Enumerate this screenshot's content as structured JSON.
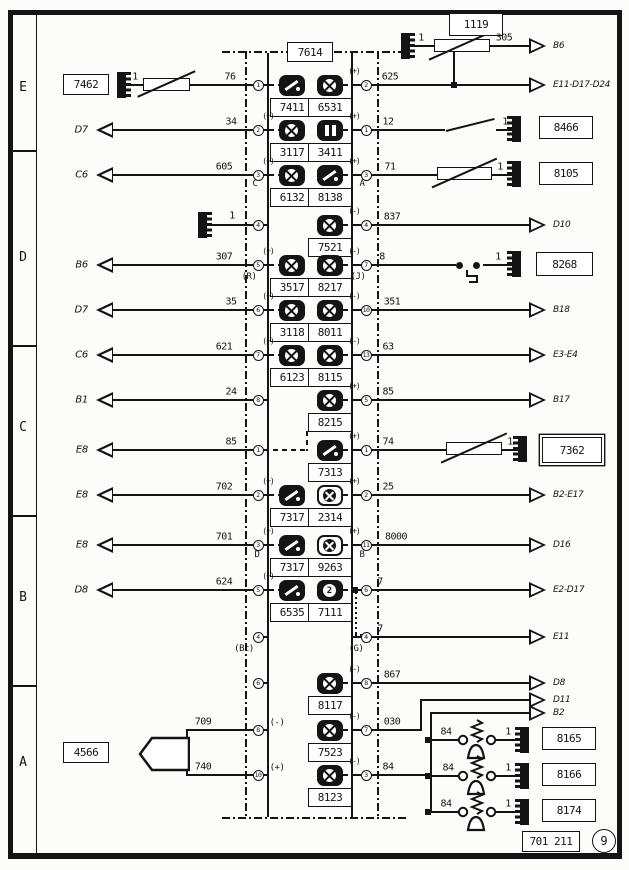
{
  "page": {
    "number": "9",
    "plate": "701 211"
  },
  "unit": {
    "id": "7614"
  },
  "ruler": [
    "E",
    "D",
    "C",
    "B",
    "A"
  ],
  "diagram": {
    "lines": [
      [
        222,
        51,
        186,
        2,
        "ddh"
      ],
      [
        222,
        817,
        186,
        2,
        "ddh"
      ],
      [
        245,
        51,
        2,
        768,
        "ddv"
      ],
      [
        377,
        51,
        2,
        768,
        "ddv"
      ],
      [
        267,
        53,
        2,
        764,
        "s"
      ],
      [
        351,
        53,
        2,
        764,
        "s"
      ],
      [
        128,
        84,
        16,
        2,
        "s"
      ],
      [
        190,
        84,
        63,
        2,
        "s"
      ],
      [
        112,
        129,
        141,
        2,
        "s"
      ],
      [
        112,
        174,
        141,
        2,
        "s"
      ],
      [
        208,
        224,
        45,
        2,
        "s"
      ],
      [
        112,
        264,
        141,
        2,
        "s"
      ],
      [
        112,
        309,
        141,
        2,
        "s"
      ],
      [
        112,
        354,
        141,
        2,
        "s"
      ],
      [
        112,
        399,
        141,
        2,
        "s"
      ],
      [
        112,
        449,
        141,
        2,
        "s"
      ],
      [
        112,
        494,
        141,
        2,
        "s"
      ],
      [
        112,
        544,
        141,
        2,
        "s"
      ],
      [
        112,
        589,
        141,
        2,
        "s"
      ],
      [
        188,
        729,
        65,
        2,
        "s"
      ],
      [
        188,
        774,
        65,
        2,
        "s"
      ],
      [
        186,
        729,
        2,
        47,
        "s"
      ],
      [
        411,
        45,
        24,
        2,
        "s"
      ],
      [
        490,
        45,
        40,
        2,
        "s"
      ],
      [
        453,
        51,
        2,
        35,
        "s"
      ],
      [
        371,
        84,
        159,
        2,
        "s"
      ],
      [
        371,
        129,
        74,
        2,
        "s"
      ],
      [
        496,
        129,
        16,
        2,
        "s"
      ],
      [
        371,
        174,
        66,
        2,
        "s"
      ],
      [
        492,
        174,
        20,
        2,
        "s"
      ],
      [
        371,
        224,
        159,
        2,
        "s"
      ],
      [
        371,
        264,
        85,
        2,
        "s"
      ],
      [
        483,
        264,
        29,
        2,
        "s"
      ],
      [
        371,
        309,
        159,
        2,
        "s"
      ],
      [
        371,
        354,
        159,
        2,
        "s"
      ],
      [
        371,
        399,
        159,
        2,
        "s"
      ],
      [
        371,
        449,
        75,
        2,
        "s"
      ],
      [
        502,
        449,
        16,
        2,
        "s"
      ],
      [
        371,
        494,
        159,
        2,
        "s"
      ],
      [
        371,
        544,
        159,
        2,
        "s"
      ],
      [
        371,
        589,
        159,
        2,
        "s"
      ],
      [
        371,
        636,
        159,
        2,
        "s"
      ],
      [
        371,
        682,
        159,
        2,
        "s"
      ],
      [
        420,
        699,
        110,
        2,
        "s"
      ],
      [
        420,
        699,
        2,
        32,
        "s"
      ],
      [
        430,
        712,
        110,
        2,
        "s"
      ],
      [
        430,
        712,
        2,
        101,
        "s"
      ],
      [
        371,
        729,
        51,
        2,
        "s"
      ],
      [
        371,
        774,
        59,
        2,
        "s"
      ],
      [
        430,
        739,
        29,
        2,
        "s"
      ],
      [
        496,
        739,
        24,
        2,
        "s"
      ],
      [
        430,
        775,
        29,
        2,
        "s"
      ],
      [
        496,
        775,
        24,
        2,
        "s"
      ],
      [
        430,
        811,
        29,
        2,
        "s"
      ],
      [
        496,
        811,
        24,
        2,
        "s"
      ],
      [
        264,
        449,
        44,
        2,
        "dah"
      ],
      [
        306,
        431,
        2,
        20,
        "dav"
      ],
      [
        355,
        592,
        2,
        44,
        "dov"
      ],
      [
        355,
        634,
        8,
        2,
        "doh"
      ],
      [
        466,
        270,
        2,
        7,
        "s"
      ],
      [
        466,
        275,
        12,
        2,
        "s"
      ],
      [
        476,
        275,
        2,
        8,
        "s"
      ],
      [
        469,
        281,
        9,
        2,
        "s"
      ]
    ],
    "squares": [
      [
        454,
        85
      ],
      [
        355,
        590
      ],
      [
        428,
        740
      ],
      [
        428,
        776
      ],
      [
        428,
        812
      ]
    ],
    "dots": [
      [
        459,
        265
      ],
      [
        476,
        265
      ]
    ],
    "grounds": [
      [
        117,
        72,
        "r"
      ],
      [
        198,
        212,
        "r"
      ],
      [
        401,
        33,
        "r"
      ],
      [
        512,
        116,
        "l"
      ],
      [
        512,
        161,
        "l"
      ],
      [
        512,
        251,
        "l"
      ],
      [
        518,
        436,
        "l"
      ],
      [
        520,
        727,
        "l"
      ],
      [
        520,
        763,
        "l"
      ],
      [
        520,
        799,
        "l"
      ]
    ],
    "resistors": [
      [
        143,
        78,
        47
      ],
      [
        434,
        39,
        56
      ],
      [
        437,
        167,
        55
      ],
      [
        446,
        442,
        56
      ]
    ],
    "switches": [
      [
        446,
        130,
        50,
        -14
      ]
    ],
    "pumps": [
      [
        453,
        718
      ],
      [
        453,
        754
      ],
      [
        453,
        790
      ]
    ],
    "horn": [
      138,
      736
    ],
    "arrows": [
      [
        "l",
        96,
        130,
        "D7"
      ],
      [
        "l",
        96,
        175,
        "C6"
      ],
      [
        "l",
        96,
        265,
        "B6"
      ],
      [
        "l",
        96,
        310,
        "D7"
      ],
      [
        "l",
        96,
        355,
        "C6"
      ],
      [
        "l",
        96,
        400,
        "B1"
      ],
      [
        "l",
        96,
        450,
        "E8"
      ],
      [
        "l",
        96,
        495,
        "E8"
      ],
      [
        "l",
        96,
        545,
        "E8"
      ],
      [
        "l",
        96,
        590,
        "D8"
      ],
      [
        "r",
        546,
        46,
        "B6"
      ],
      [
        "r",
        546,
        85,
        "E11-D17-D24"
      ],
      [
        "r",
        546,
        225,
        "D10"
      ],
      [
        "r",
        546,
        310,
        "B18"
      ],
      [
        "r",
        546,
        355,
        "E3-E4"
      ],
      [
        "r",
        546,
        400,
        "B17"
      ],
      [
        "r",
        546,
        495,
        "B2-E17"
      ],
      [
        "r",
        546,
        545,
        "D16"
      ],
      [
        "r",
        546,
        590,
        "E2-D17"
      ],
      [
        "r",
        546,
        637,
        "E11"
      ],
      [
        "r",
        546,
        683,
        "D8"
      ],
      [
        "r",
        546,
        700,
        "D11"
      ],
      [
        "r",
        546,
        713,
        "B2"
      ]
    ],
    "boxes": [
      [
        "7462",
        63,
        74,
        46,
        21,
        0
      ],
      [
        "1119",
        449,
        13,
        54,
        23,
        0
      ],
      [
        "8466",
        539,
        116,
        54,
        23,
        0
      ],
      [
        "8105",
        539,
        162,
        54,
        23,
        0
      ],
      [
        "8268",
        536,
        252,
        57,
        24,
        0
      ],
      [
        "7362",
        542,
        437,
        60,
        26,
        1
      ],
      [
        "4566",
        63,
        742,
        46,
        21,
        0
      ],
      [
        "8165",
        542,
        727,
        54,
        23,
        0
      ],
      [
        "8166",
        542,
        763,
        54,
        23,
        0
      ],
      [
        "8174",
        542,
        799,
        54,
        23,
        0
      ]
    ],
    "pins": [
      [
        "1",
        258,
        85
      ],
      [
        "2",
        258,
        130
      ],
      [
        "3",
        258,
        175
      ],
      [
        "4",
        258,
        225
      ],
      [
        "5",
        258,
        265
      ],
      [
        "6",
        258,
        310
      ],
      [
        "7",
        258,
        355
      ],
      [
        "8",
        258,
        400
      ],
      [
        "1",
        258,
        450
      ],
      [
        "2",
        258,
        495
      ],
      [
        "3",
        258,
        545
      ],
      [
        "5",
        258,
        590
      ],
      [
        "4",
        258,
        637
      ],
      [
        "6",
        258,
        683
      ],
      [
        "8",
        258,
        730
      ],
      [
        "10",
        258,
        775
      ],
      [
        "2",
        366,
        85
      ],
      [
        "1",
        366,
        130
      ],
      [
        "3",
        366,
        175
      ],
      [
        "4",
        366,
        225
      ],
      [
        "7",
        366,
        265
      ],
      [
        "10",
        366,
        310
      ],
      [
        "13",
        366,
        355
      ],
      [
        "5",
        366,
        400
      ],
      [
        "1",
        366,
        450
      ],
      [
        "2",
        366,
        495
      ],
      [
        "11",
        366,
        545
      ],
      [
        "6",
        366,
        590
      ],
      [
        "4",
        366,
        637
      ],
      [
        "8",
        366,
        683
      ],
      [
        "7",
        366,
        730
      ],
      [
        "3",
        366,
        775
      ]
    ],
    "icons": [
      [
        "7411",
        "L",
        85,
        "needle",
        ""
      ],
      [
        "6531",
        "R",
        85,
        "cross",
        "+"
      ],
      [
        "3117",
        "L",
        130,
        "cross",
        "+"
      ],
      [
        "3411",
        "R",
        130,
        "bars",
        "+"
      ],
      [
        "6132",
        "L",
        175,
        "cross",
        "+"
      ],
      [
        "8138",
        "R",
        175,
        "needle",
        "+"
      ],
      [
        "7521",
        "R",
        225,
        "cross",
        "-"
      ],
      [
        "3517",
        "L",
        265,
        "cross",
        "+"
      ],
      [
        "8217",
        "R",
        265,
        "cross",
        "-"
      ],
      [
        "3118",
        "L",
        310,
        "cross",
        "+"
      ],
      [
        "8011",
        "R",
        310,
        "cross",
        "-"
      ],
      [
        "6123",
        "L",
        355,
        "cross",
        "+"
      ],
      [
        "8115",
        "R",
        355,
        "cross",
        "-"
      ],
      [
        "8215",
        "R",
        400,
        "cross",
        "+"
      ],
      [
        "7313",
        "R",
        450,
        "needle",
        "+"
      ],
      [
        "7317",
        "L",
        495,
        "needle",
        "+"
      ],
      [
        "2314",
        "R",
        495,
        "crossdark",
        "+"
      ],
      [
        "7317",
        "L",
        545,
        "needle",
        "+"
      ],
      [
        "9263",
        "R",
        545,
        "crossdark",
        "+"
      ],
      [
        "6535",
        "L",
        590,
        "needle",
        "+"
      ],
      [
        "7111",
        "R",
        590,
        "clock",
        ""
      ],
      [
        "8117",
        "R",
        683,
        "cross",
        "-"
      ],
      [
        "7523",
        "R",
        730,
        "cross",
        "-"
      ],
      [
        "8123",
        "R",
        775,
        "cross",
        "-"
      ]
    ],
    "wire_labels": [
      [
        "1",
        135,
        77
      ],
      [
        "76",
        230,
        77
      ],
      [
        "34",
        231,
        122
      ],
      [
        "605",
        224,
        167
      ],
      [
        "1",
        232,
        216
      ],
      [
        "307",
        224,
        257
      ],
      [
        "35",
        231,
        302
      ],
      [
        "621",
        224,
        347
      ],
      [
        "24",
        231,
        392
      ],
      [
        "85",
        231,
        442
      ],
      [
        "702",
        224,
        487
      ],
      [
        "701",
        224,
        537
      ],
      [
        "624",
        224,
        582
      ],
      [
        "709",
        203,
        722
      ],
      [
        "740",
        203,
        767
      ],
      [
        "1",
        421,
        38
      ],
      [
        "305",
        504,
        38
      ],
      [
        "625",
        390,
        77
      ],
      [
        "12",
        388,
        122
      ],
      [
        "1",
        505,
        122
      ],
      [
        "71",
        390,
        167
      ],
      [
        "1",
        500,
        167
      ],
      [
        "837",
        392,
        217
      ],
      [
        "8",
        382,
        257
      ],
      [
        "1",
        498,
        257
      ],
      [
        "351",
        392,
        302
      ],
      [
        "63",
        388,
        347
      ],
      [
        "85",
        388,
        392
      ],
      [
        "74",
        388,
        442
      ],
      [
        "1",
        510,
        442
      ],
      [
        "25",
        388,
        487
      ],
      [
        "8000",
        396,
        537
      ],
      [
        "7",
        380,
        582
      ],
      [
        "7",
        380,
        629
      ],
      [
        "867",
        392,
        675
      ],
      [
        "030",
        392,
        722
      ],
      [
        "84",
        388,
        767
      ],
      [
        "84",
        446,
        732
      ],
      [
        "1",
        508,
        732
      ],
      [
        "84",
        448,
        768
      ],
      [
        "1",
        508,
        768
      ],
      [
        "84",
        446,
        804
      ],
      [
        "1",
        508,
        804
      ]
    ],
    "texts": [
      [
        "C",
        255,
        184
      ],
      [
        "A",
        362,
        184
      ],
      [
        "(R)",
        249,
        277
      ],
      [
        "(J)",
        358,
        277
      ],
      [
        "D",
        257,
        555
      ],
      [
        "B",
        362,
        555
      ],
      [
        "(Bc)",
        244,
        649
      ],
      [
        "(G)",
        356,
        649
      ],
      [
        "(-)",
        277,
        723
      ],
      [
        "(+)",
        277,
        768
      ]
    ]
  }
}
